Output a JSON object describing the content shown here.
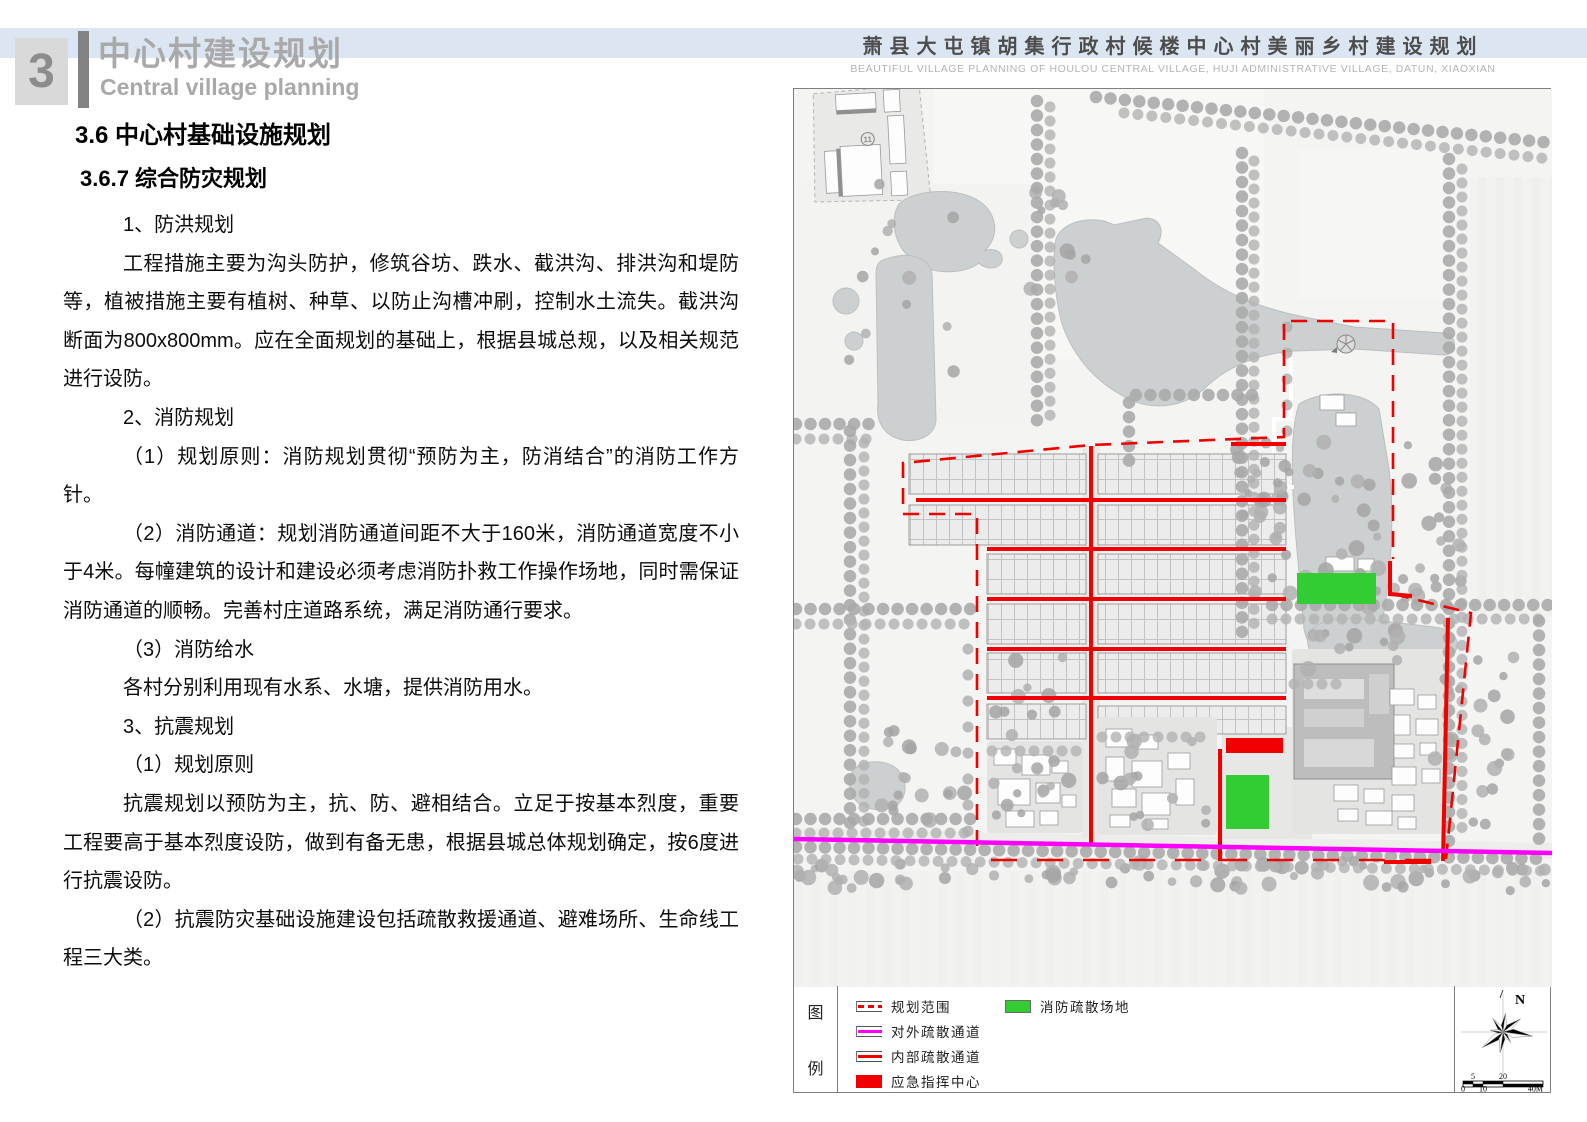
{
  "page": {
    "chapter_number": "3",
    "chapter_title_cn": "中心村建设规划",
    "chapter_title_en": "Central village planning",
    "doc_title_cn": "萧县大屯镇胡集行政村候楼中心村美丽乡村建设规划",
    "doc_title_en": "BEAUTIFUL VILLAGE PLANNING OF HOULOU CENTRAL VILLAGE, HUJI ADMINISTRATIVE VILLAGE, DATUN, XIAOXIAN"
  },
  "content": {
    "heading1": "3.6 中心村基础设施规划",
    "heading2": "3.6.7 综合防灾规划",
    "paragraphs": [
      "1、防洪规划",
      "工程措施主要为沟头防护，修筑谷坊、跌水、截洪沟、排洪沟和堤防等，植被措施主要有植树、种草、以防止沟槽冲刷，控制水土流失。截洪沟断面为800x800mm。应在全面规划的基础上，根据县城总规，以及相关规范进行设防。",
      "2、消防规划",
      "（1）规划原则：消防规划贯彻“预防为主，防消结合”的消防工作方针。",
      "（2）消防通道：规划消防通道间距不大于160米，消防通道宽度不小于4米。每幢建筑的设计和建设必须考虑消防扑救工作操作场地，同时需保证消防通道的顺畅。完善村庄道路系统，满足消防通行要求。",
      "（3）消防给水",
      "各村分别利用现有水系、水塘，提供消防用水。",
      "3、抗震规划",
      "（1）规划原则",
      "抗震规划以预防为主，抗、防、避相结合。立足于按基本烈度，重要工程要高于基本烈度设防，做到有备无患，根据县城总体规划确定，按6度进行抗震设防。",
      "（2）抗震防灾基础设施建设包括疏散救援通道、避难场所、生命线工程三大类。"
    ]
  },
  "map": {
    "parcel_label": "11",
    "legend_title_chars": [
      "图",
      "例"
    ],
    "legend_rows": [
      [
        {
          "symbol": "red-dashed-line",
          "label": "规划范围"
        },
        {
          "symbol": "green-rect",
          "label": "消防疏散场地"
        }
      ],
      [
        {
          "symbol": "magenta-line",
          "label": "对外疏散通道"
        }
      ],
      [
        {
          "symbol": "red-line",
          "label": "内部疏散通道"
        }
      ],
      [
        {
          "symbol": "red-rect",
          "label": "应急指挥中心"
        }
      ]
    ],
    "north_label": "N",
    "scale": {
      "above": [
        "5",
        "20"
      ],
      "below": [
        "0",
        "10",
        "40M"
      ]
    }
  },
  "colors": {
    "band_blue": "#dce6f2",
    "route_red": "#f10000",
    "evacuation_green": "#33cc33",
    "external_route_magenta": "#ff00ff"
  }
}
